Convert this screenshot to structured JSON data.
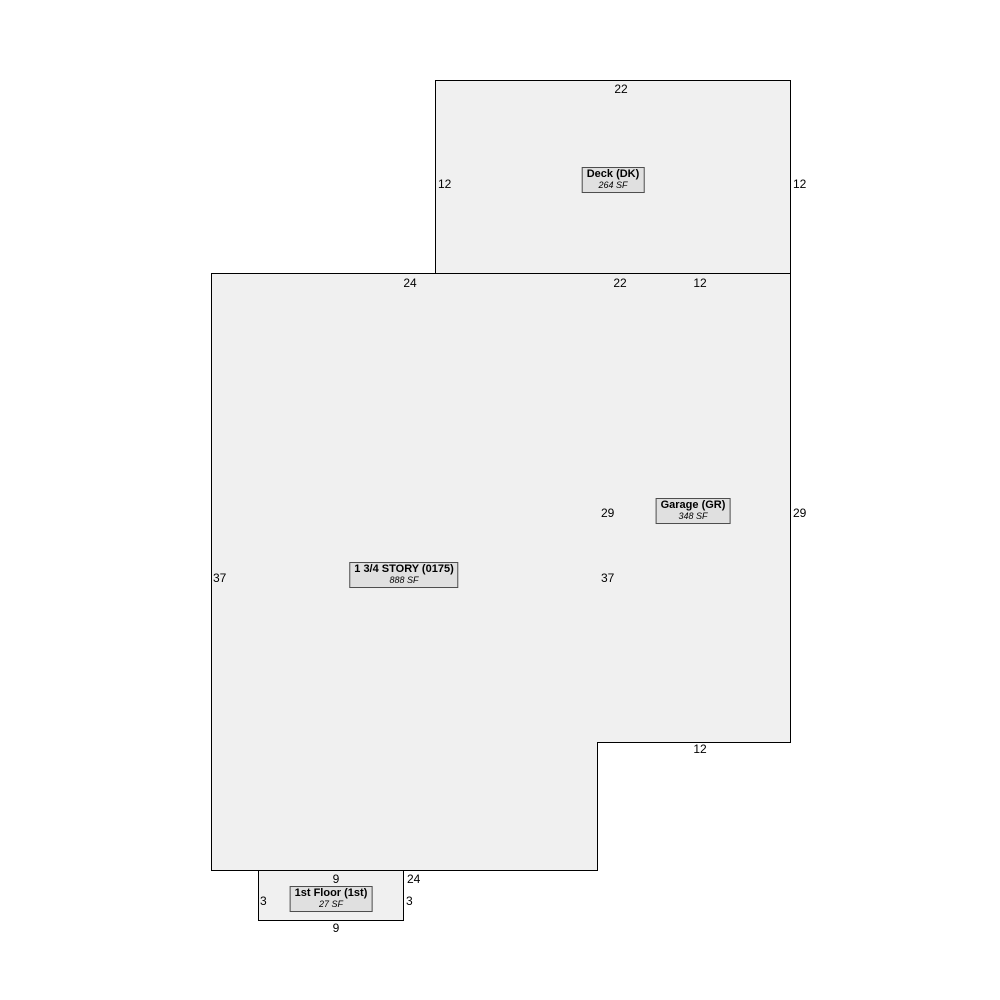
{
  "colors": {
    "background": "#ffffff",
    "room_fill": "#f0f0f0",
    "room_border": "#000000",
    "tag_fill": "#e0e0e0",
    "tag_border": "#4d4d4d",
    "text": "#000000"
  },
  "rooms": [
    {
      "id": "deck",
      "title": "Deck (DK)",
      "area": "264 SF"
    },
    {
      "id": "story",
      "title": "1 3/4 STORY (0175)",
      "area": "888 SF"
    },
    {
      "id": "garage",
      "title": "Garage (GR)",
      "area": "348 SF"
    },
    {
      "id": "first",
      "title": "1st Floor (1st)",
      "area": "27 SF"
    }
  ],
  "dims": {
    "deck_top": "22",
    "deck_left": "12",
    "deck_right": "12",
    "main_top": "24",
    "deck_bottom": "22",
    "garage_top": "12",
    "garage_left": "29",
    "garage_right": "29",
    "main_left": "37",
    "main_right": "37",
    "garage_bottom": "12",
    "first_top": "9",
    "main_bottom": "24",
    "first_left": "3",
    "first_right": "3",
    "first_bottom": "9"
  }
}
